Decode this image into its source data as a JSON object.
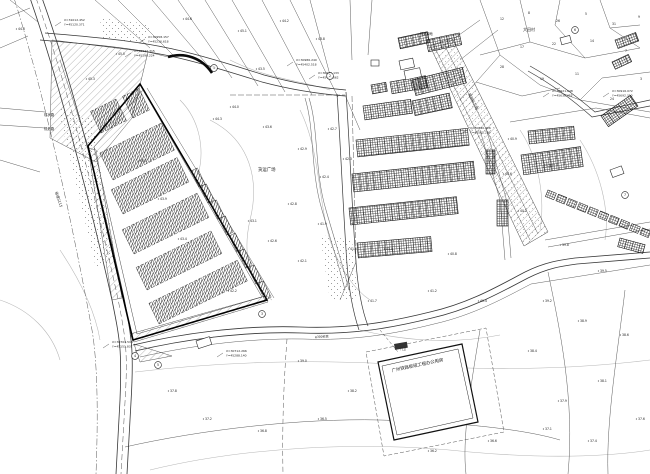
{
  "drawing": {
    "type": "cad-site-plan",
    "background": "#ffffff",
    "line_color": "#3a3a3a",
    "contour_color": "#b5b5b5",
    "hatch_color": "#222222",
    "building_label": "广州铁路枢纽工程办公用房"
  },
  "area_labels": [
    {
      "x": 258,
      "y": 171,
      "t": "货运广场",
      "s": 4.4
    },
    {
      "x": 44,
      "y": 116,
      "t": "现状路",
      "s": 3.4
    },
    {
      "x": 44,
      "y": 130,
      "t": "规划路",
      "s": 3.4
    },
    {
      "x": 55,
      "y": 192,
      "t": "省道S115",
      "s": 3.6,
      "r": 72
    },
    {
      "x": 523,
      "y": 31,
      "t": "大田村",
      "s": 4.0
    },
    {
      "x": 543,
      "y": 167,
      "t": "上边村",
      "s": 4.0
    },
    {
      "x": 420,
      "y": 35,
      "t": "规划绿地",
      "s": 3.2
    },
    {
      "x": 468,
      "y": 94,
      "t": "规划纵三路",
      "s": 3.6,
      "r": 63
    },
    {
      "x": 400,
      "y": 350,
      "t": "门卫",
      "s": 3.0
    },
    {
      "x": 315,
      "y": 338,
      "t": "φ300砼管",
      "s": 3.0,
      "r": -3
    },
    {
      "x": 392,
      "y": 372,
      "t": "广州铁路枢纽工程办公用房",
      "s": 4.4,
      "r": -12
    }
  ],
  "coordinate_callouts": [
    {
      "x": 148,
      "y": 38,
      "l1": "X=30958.157",
      "l2": "Y=45236.618"
    },
    {
      "x": 134,
      "y": 52,
      "l1": "X=30942.315",
      "l2": "Y=45198.224"
    },
    {
      "x": 64,
      "y": 21,
      "l1": "X=31012.452",
      "l2": "Y=45120.371"
    },
    {
      "x": 296,
      "y": 61,
      "l1": "X=30986.240",
      "l2": "Y=45402.518"
    },
    {
      "x": 318,
      "y": 74,
      "l1": "X=30961.133",
      "l2": "Y=45430.662"
    },
    {
      "x": 470,
      "y": 129,
      "l1": "X=30890.426",
      "l2": "Y=45561.209"
    },
    {
      "x": 552,
      "y": 92,
      "l1": "X=30921.648",
      "l2": "Y=45638.455"
    },
    {
      "x": 612,
      "y": 92,
      "l1": "X=30916.072",
      "l2": "Y=45692.310"
    },
    {
      "x": 112,
      "y": 343,
      "l1": "X=30704.518",
      "l2": "Y=45151.837"
    },
    {
      "x": 226,
      "y": 352,
      "l1": "X=30712.266",
      "l2": "Y=45288.140"
    }
  ],
  "elevation_points": [
    {
      "x": 185,
      "y": 20,
      "v": "44.6"
    },
    {
      "x": 240,
      "y": 32,
      "v": "45.1"
    },
    {
      "x": 282,
      "y": 22,
      "v": "44.2"
    },
    {
      "x": 318,
      "y": 40,
      "v": "43.8"
    },
    {
      "x": 258,
      "y": 70,
      "v": "43.5"
    },
    {
      "x": 232,
      "y": 108,
      "v": "44.0"
    },
    {
      "x": 265,
      "y": 128,
      "v": "43.6"
    },
    {
      "x": 300,
      "y": 150,
      "v": "42.9"
    },
    {
      "x": 322,
      "y": 178,
      "v": "42.4"
    },
    {
      "x": 290,
      "y": 205,
      "v": "42.8"
    },
    {
      "x": 320,
      "y": 225,
      "v": "41.9"
    },
    {
      "x": 350,
      "y": 250,
      "v": "41.5"
    },
    {
      "x": 300,
      "y": 262,
      "v": "42.1"
    },
    {
      "x": 270,
      "y": 242,
      "v": "42.6"
    },
    {
      "x": 250,
      "y": 222,
      "v": "43.1"
    },
    {
      "x": 215,
      "y": 120,
      "v": "44.3"
    },
    {
      "x": 330,
      "y": 130,
      "v": "42.7"
    },
    {
      "x": 345,
      "y": 160,
      "v": "42.3"
    },
    {
      "x": 510,
      "y": 140,
      "v": "40.9"
    },
    {
      "x": 505,
      "y": 175,
      "v": "40.6"
    },
    {
      "x": 520,
      "y": 212,
      "v": "40.2"
    },
    {
      "x": 562,
      "y": 246,
      "v": "39.8"
    },
    {
      "x": 600,
      "y": 272,
      "v": "39.5"
    },
    {
      "x": 545,
      "y": 302,
      "v": "39.2"
    },
    {
      "x": 580,
      "y": 322,
      "v": "38.9"
    },
    {
      "x": 622,
      "y": 336,
      "v": "38.6"
    },
    {
      "x": 530,
      "y": 352,
      "v": "38.4"
    },
    {
      "x": 600,
      "y": 382,
      "v": "38.1"
    },
    {
      "x": 560,
      "y": 402,
      "v": "37.9"
    },
    {
      "x": 638,
      "y": 420,
      "v": "37.6"
    },
    {
      "x": 590,
      "y": 442,
      "v": "37.4"
    },
    {
      "x": 480,
      "y": 302,
      "v": "40.4"
    },
    {
      "x": 430,
      "y": 292,
      "v": "41.2"
    },
    {
      "x": 370,
      "y": 302,
      "v": "41.7"
    },
    {
      "x": 230,
      "y": 292,
      "v": "42.2"
    },
    {
      "x": 180,
      "y": 240,
      "v": "43.4"
    },
    {
      "x": 160,
      "y": 200,
      "v": "43.9"
    },
    {
      "x": 140,
      "y": 162,
      "v": "44.5"
    },
    {
      "x": 88,
      "y": 80,
      "v": "45.3"
    },
    {
      "x": 118,
      "y": 55,
      "v": "45.0"
    },
    {
      "x": 205,
      "y": 420,
      "v": "37.2"
    },
    {
      "x": 260,
      "y": 432,
      "v": "36.8"
    },
    {
      "x": 320,
      "y": 420,
      "v": "36.5"
    },
    {
      "x": 170,
      "y": 392,
      "v": "37.8"
    },
    {
      "x": 350,
      "y": 392,
      "v": "38.2"
    },
    {
      "x": 300,
      "y": 362,
      "v": "39.0"
    },
    {
      "x": 430,
      "y": 452,
      "v": "36.2"
    },
    {
      "x": 490,
      "y": 442,
      "v": "36.6"
    },
    {
      "x": 545,
      "y": 430,
      "v": "37.1"
    },
    {
      "x": 18,
      "y": 30,
      "v": "44.8"
    },
    {
      "x": 386,
      "y": 250,
      "v": "41.0"
    },
    {
      "x": 450,
      "y": 255,
      "v": "40.8"
    }
  ],
  "parcel_numbers": [
    {
      "x": 500,
      "y": 20,
      "v": "12"
    },
    {
      "x": 528,
      "y": 14,
      "v": "8"
    },
    {
      "x": 556,
      "y": 22,
      "v": "26"
    },
    {
      "x": 585,
      "y": 15,
      "v": "5"
    },
    {
      "x": 612,
      "y": 25,
      "v": "31"
    },
    {
      "x": 638,
      "y": 18,
      "v": "9"
    },
    {
      "x": 520,
      "y": 48,
      "v": "17"
    },
    {
      "x": 552,
      "y": 45,
      "v": "22"
    },
    {
      "x": 590,
      "y": 42,
      "v": "14"
    },
    {
      "x": 625,
      "y": 52,
      "v": "7"
    },
    {
      "x": 500,
      "y": 68,
      "v": "28"
    },
    {
      "x": 540,
      "y": 80,
      "v": "19"
    },
    {
      "x": 640,
      "y": 80,
      "v": "3"
    },
    {
      "x": 610,
      "y": 100,
      "v": "24"
    },
    {
      "x": 575,
      "y": 75,
      "v": "11"
    }
  ],
  "markers": [
    {
      "x": 214,
      "y": 68,
      "n": "1"
    },
    {
      "x": 330,
      "y": 76,
      "n": "2"
    },
    {
      "x": 262,
      "y": 314,
      "n": "3"
    },
    {
      "x": 135,
      "y": 356,
      "n": "4"
    },
    {
      "x": 158,
      "y": 365,
      "n": "5"
    },
    {
      "x": 575,
      "y": 30,
      "n": "6"
    },
    {
      "x": 625,
      "y": 195,
      "n": "7"
    }
  ]
}
